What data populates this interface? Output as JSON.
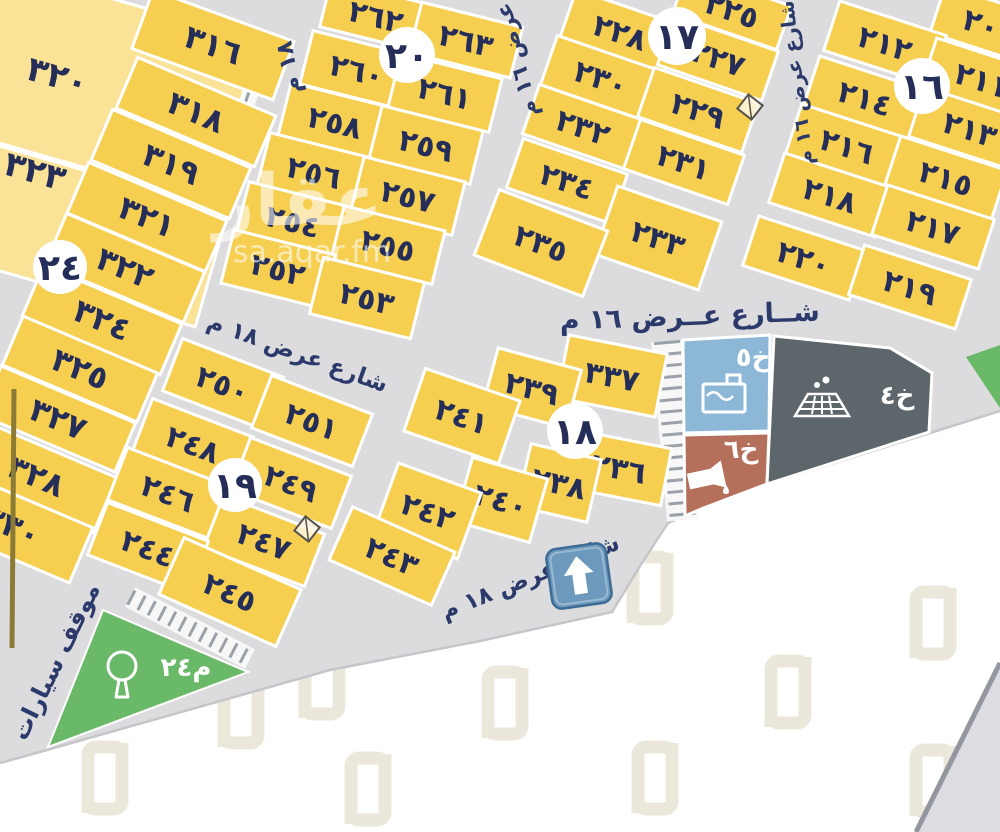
{
  "colors": {
    "parcel_yellow": "#f6cf50",
    "parcel_pale": "#fae296",
    "parcel_stroke": "#ffffff",
    "street_gray": "#dcdcde",
    "text_navy": "#242e58",
    "street_text": "#2b3a6b",
    "park_green": "#69b969",
    "service_blue": "#8db7d7",
    "service_red": "#b4705a",
    "service_dark": "#5d666b",
    "sign_blue": "#6d9abc",
    "sign_border": "#3d6b94",
    "watermark_beige": "#ece7db",
    "tick_gray": "#9ba1a8",
    "olive": "#8c7b35",
    "boundary_gray": "#c6c6ca",
    "wedge_gray": "#dcdce1",
    "wedge_edge": "#9496a0"
  },
  "map": {
    "blocks": [
      {
        "id": "24",
        "label": "٢٤",
        "x": 60,
        "y": 267,
        "r": 27
      },
      {
        "id": "20",
        "label": "٢٠",
        "x": 407,
        "y": 55,
        "r": 28
      },
      {
        "id": "17",
        "label": "١٧",
        "x": 677,
        "y": 36,
        "r": 29
      },
      {
        "id": "16",
        "label": "١٦",
        "x": 922,
        "y": 86,
        "r": 28
      },
      {
        "id": "19",
        "label": "١٩",
        "x": 235,
        "y": 485,
        "r": 27
      },
      {
        "id": "18",
        "label": "١٨",
        "x": 575,
        "y": 431,
        "r": 28
      }
    ],
    "parcels": [
      {
        "id": "320",
        "label": "٣٢٠",
        "x": 105,
        "y": 85,
        "w": 270,
        "h": 170,
        "a": 16,
        "v": "pale",
        "lx": 57,
        "ly": 90,
        "fs": 34
      },
      {
        "id": "323",
        "label": "٣٢٣",
        "x": 82,
        "y": 232,
        "w": 270,
        "h": 120,
        "a": 16,
        "v": "pale",
        "lx": 20,
        "ly": 187,
        "fs": 34
      },
      {
        "id": "316",
        "label": "٣١٦",
        "x": 213,
        "y": 45,
        "w": 150,
        "h": 62,
        "a": 20,
        "fs": 32
      },
      {
        "id": "318",
        "label": "٣١٨",
        "x": 196,
        "y": 112,
        "w": 150,
        "h": 55,
        "a": 23,
        "fs": 32
      },
      {
        "id": "319",
        "label": "٣١٩",
        "x": 171,
        "y": 164,
        "w": 150,
        "h": 55,
        "a": 23,
        "fs": 32
      },
      {
        "id": "321",
        "label": "٣٢١",
        "x": 147,
        "y": 217,
        "w": 150,
        "h": 55,
        "a": 23,
        "fs": 32
      },
      {
        "id": "322",
        "label": "٣٢٢",
        "x": 125,
        "y": 268,
        "w": 150,
        "h": 55,
        "a": 23,
        "fs": 32
      },
      {
        "id": "324",
        "label": "٣٢٤",
        "x": 102,
        "y": 320,
        "w": 150,
        "h": 55,
        "a": 23,
        "fs": 32
      },
      {
        "id": "325",
        "label": "٣٢٥",
        "x": 80,
        "y": 369,
        "w": 146,
        "h": 53,
        "a": 23,
        "fs": 32
      },
      {
        "id": "327",
        "label": "٣٢٧",
        "x": 58,
        "y": 419,
        "w": 146,
        "h": 53,
        "a": 23,
        "fs": 32
      },
      {
        "id": "328",
        "label": "٣٢٨",
        "x": 36,
        "y": 476,
        "w": 150,
        "h": 60,
        "a": 23,
        "fs": 32
      },
      {
        "id": "330",
        "label": "٣٣٠",
        "x": 12,
        "y": 526,
        "w": 150,
        "h": 60,
        "a": 23,
        "fs": 32
      },
      {
        "id": "262",
        "label": "٢٦٢",
        "x": 376,
        "y": 16,
        "w": 104,
        "h": 48,
        "a": 14
      },
      {
        "id": "263",
        "label": "٢٦٣",
        "x": 466,
        "y": 40,
        "w": 104,
        "h": 52,
        "a": 14
      },
      {
        "id": "260",
        "label": "٢٦٠",
        "x": 357,
        "y": 70,
        "w": 104,
        "h": 55,
        "a": 14
      },
      {
        "id": "261",
        "label": "٢٦١",
        "x": 445,
        "y": 93,
        "w": 104,
        "h": 55,
        "a": 14
      },
      {
        "id": "258",
        "label": "٢٥٨",
        "x": 335,
        "y": 122,
        "w": 104,
        "h": 55,
        "a": 14
      },
      {
        "id": "259",
        "label": "٢٥٩",
        "x": 426,
        "y": 145,
        "w": 104,
        "h": 55,
        "a": 14
      },
      {
        "id": "256",
        "label": "٢٥٦",
        "x": 314,
        "y": 172,
        "w": 104,
        "h": 55,
        "a": 14
      },
      {
        "id": "257",
        "label": "٢٥٧",
        "x": 408,
        "y": 196,
        "w": 104,
        "h": 55,
        "a": 14
      },
      {
        "id": "254",
        "label": "٢٥٤",
        "x": 293,
        "y": 221,
        "w": 104,
        "h": 55,
        "a": 14
      },
      {
        "id": "255",
        "label": "٢٥٥",
        "x": 388,
        "y": 245,
        "w": 104,
        "h": 55,
        "a": 14
      },
      {
        "id": "252",
        "label": "٢٥٢",
        "x": 278,
        "y": 269,
        "w": 104,
        "h": 55,
        "a": 14
      },
      {
        "id": "253",
        "label": "٢٥٣",
        "x": 367,
        "y": 298,
        "w": 104,
        "h": 58,
        "a": 14
      },
      {
        "id": "225",
        "label": "٢٢٥",
        "x": 732,
        "y": 10,
        "w": 110,
        "h": 46,
        "a": 19
      },
      {
        "id": "228",
        "label": "٢٢٨",
        "x": 620,
        "y": 32,
        "w": 110,
        "h": 52,
        "a": 19
      },
      {
        "id": "227",
        "label": "٢٢٧",
        "x": 718,
        "y": 58,
        "w": 110,
        "h": 52,
        "a": 19
      },
      {
        "id": "230",
        "label": "٢٣٠",
        "x": 601,
        "y": 78,
        "w": 110,
        "h": 52,
        "a": 19
      },
      {
        "id": "229",
        "label": "٢٢٩",
        "x": 698,
        "y": 110,
        "w": 110,
        "h": 52,
        "a": 19
      },
      {
        "id": "232",
        "label": "٢٣٢",
        "x": 583,
        "y": 127,
        "w": 110,
        "h": 52,
        "a": 19
      },
      {
        "id": "231",
        "label": "٢٣١",
        "x": 684,
        "y": 162,
        "w": 110,
        "h": 52,
        "a": 19
      },
      {
        "id": "234",
        "label": "٢٣٤",
        "x": 567,
        "y": 181,
        "w": 110,
        "h": 52,
        "a": 19
      },
      {
        "id": "233",
        "label": "٢٣٣",
        "x": 658,
        "y": 238,
        "w": 110,
        "h": 72,
        "a": 19
      },
      {
        "id": "235",
        "label": "٢٣٥",
        "x": 541,
        "y": 243,
        "w": 116,
        "h": 70,
        "a": 21
      },
      {
        "id": "209",
        "label": "٢٠٩",
        "x": 990,
        "y": 26,
        "w": 110,
        "h": 50,
        "a": 18
      },
      {
        "id": "212",
        "label": "٢١٢",
        "x": 885,
        "y": 43,
        "w": 112,
        "h": 52,
        "a": 18
      },
      {
        "id": "211",
        "label": "٢١١",
        "x": 982,
        "y": 80,
        "w": 112,
        "h": 52,
        "a": 18
      },
      {
        "id": "214",
        "label": "٢١٤",
        "x": 865,
        "y": 98,
        "w": 112,
        "h": 52,
        "a": 18
      },
      {
        "id": "213",
        "label": "٢١٣",
        "x": 970,
        "y": 129,
        "w": 112,
        "h": 52,
        "a": 18
      },
      {
        "id": "216",
        "label": "٢١٦",
        "x": 847,
        "y": 146,
        "w": 112,
        "h": 52,
        "a": 18
      },
      {
        "id": "215",
        "label": "٢١٥",
        "x": 946,
        "y": 178,
        "w": 112,
        "h": 52,
        "a": 18
      },
      {
        "id": "218",
        "label": "٢١٨",
        "x": 830,
        "y": 195,
        "w": 112,
        "h": 52,
        "a": 18
      },
      {
        "id": "217",
        "label": "٢١٧",
        "x": 933,
        "y": 227,
        "w": 112,
        "h": 52,
        "a": 18
      },
      {
        "id": "220",
        "label": "٢٢٠",
        "x": 804,
        "y": 258,
        "w": 112,
        "h": 52,
        "a": 18
      },
      {
        "id": "219",
        "label": "٢١٩",
        "x": 910,
        "y": 287,
        "w": 112,
        "h": 52,
        "a": 18
      },
      {
        "id": "250",
        "label": "٢٥٠",
        "x": 223,
        "y": 384,
        "w": 108,
        "h": 56,
        "a": 21
      },
      {
        "id": "251",
        "label": "٢٥١",
        "x": 312,
        "y": 421,
        "w": 108,
        "h": 56,
        "a": 21
      },
      {
        "id": "248",
        "label": "٢٤٨",
        "x": 193,
        "y": 444,
        "w": 108,
        "h": 56,
        "a": 21
      },
      {
        "id": "249",
        "label": "٢٤٩",
        "x": 291,
        "y": 483,
        "w": 108,
        "h": 56,
        "a": 21
      },
      {
        "id": "246",
        "label": "٢٤٦",
        "x": 168,
        "y": 493,
        "w": 108,
        "h": 56,
        "a": 21
      },
      {
        "id": "247",
        "label": "٢٤٧",
        "x": 264,
        "y": 541,
        "w": 108,
        "h": 56,
        "a": 21
      },
      {
        "id": "244",
        "label": "٢٤٤",
        "x": 148,
        "y": 548,
        "w": 108,
        "h": 56,
        "a": 21
      },
      {
        "id": "245",
        "label": "٢٤٥",
        "x": 230,
        "y": 592,
        "w": 128,
        "h": 62,
        "a": 24
      },
      {
        "id": "337",
        "label": "٣٣٧",
        "x": 612,
        "y": 376,
        "w": 100,
        "h": 64,
        "a": 11
      },
      {
        "id": "239",
        "label": "٢٣٩",
        "x": 532,
        "y": 388,
        "w": 86,
        "h": 60,
        "a": 15
      },
      {
        "id": "241",
        "label": "٢٤١",
        "x": 462,
        "y": 416,
        "w": 100,
        "h": 66,
        "a": 19
      },
      {
        "id": "236",
        "label": "٢٣٦",
        "x": 619,
        "y": 468,
        "w": 96,
        "h": 58,
        "a": 11
      },
      {
        "id": "238",
        "label": "٢٣٨",
        "x": 559,
        "y": 483,
        "w": 72,
        "h": 64,
        "a": 13
      },
      {
        "id": "240",
        "label": "٢٤٠",
        "x": 501,
        "y": 500,
        "w": 78,
        "h": 66,
        "a": 16
      },
      {
        "id": "242",
        "label": "٢٤٢",
        "x": 428,
        "y": 511,
        "w": 88,
        "h": 70,
        "a": 20
      },
      {
        "id": "243",
        "label": "٢٤٣",
        "x": 392,
        "y": 556,
        "w": 112,
        "h": 58,
        "a": 24
      }
    ],
    "services": [
      {
        "id": "kh5",
        "label": "خ٥",
        "color": "service_blue",
        "icon": "water-tank-icon",
        "points": "683,340 770,335 769,431 684,433",
        "label_x": 753,
        "label_y": 366,
        "icon_x": 724,
        "icon_y": 397
      },
      {
        "id": "kh6",
        "label": "خ٦",
        "color": "service_red",
        "icon": "fuel-icon",
        "points": "684,435 769,433 767,484 701,509 685,516",
        "label_x": 741,
        "label_y": 458,
        "icon_x": 710,
        "icon_y": 477
      },
      {
        "id": "kh4",
        "label": "خ٤",
        "color": "service_dark",
        "icon": "drain-icon",
        "points": "774,336 890,348 932,373 929,432 767,484",
        "label_x": 897,
        "label_y": 404,
        "icon_x": 822,
        "icon_y": 400
      }
    ],
    "park": {
      "points": "103,610 248,672 48,747",
      "label": "م٢٤",
      "label_x": 186,
      "label_y": 676,
      "tree_x": 122,
      "tree_y": 676
    },
    "green_sliver": "966,357 1000,345 1000,408",
    "street_labels": [
      {
        "text": "شــارع عــرض ١٦ م",
        "x": 690,
        "y": 325,
        "a": -2,
        "s": 27
      },
      {
        "text": "شارع عرض ١٨ م",
        "x": 295,
        "y": 360,
        "a": 20,
        "s": 23
      },
      {
        "text": "شارع عرض ١٨ م",
        "x": 533,
        "y": 584,
        "a": -22,
        "s": 23
      },
      {
        "text": "شارع عرض ١٦ م",
        "x": 803,
        "y": 82,
        "a": -97,
        "s": 20
      },
      {
        "text": "عرض ١٦ م",
        "x": 524,
        "y": 58,
        "a": -104,
        "s": 22
      },
      {
        "text": "١٨ م",
        "x": 296,
        "y": 66,
        "a": -101,
        "s": 23
      },
      {
        "text": "موقف سيارات",
        "x": 63,
        "y": 665,
        "a": -64,
        "s": 24
      }
    ],
    "markers": [
      {
        "x": 750,
        "y": 107
      },
      {
        "x": 307,
        "y": 529
      }
    ],
    "arrow_sign": {
      "x": 579,
      "y": 576,
      "size": 60,
      "a": -8
    },
    "plan_outline": "0,0 1000,0 1000,412 930,433 767,484 700,509 668,523 640,566 612,612 480,641 330,670 22,757 0,763",
    "boundary_line": "0,763 22,757 330,670 480,641 612,612 640,566 668,523 700,509 767,484 930,433 1000,411",
    "wedge": {
      "points": "1000,663 1000,832 916,832",
      "edge": "1000,663 916,832"
    },
    "olive_line": {
      "x1": 14,
      "y1": 389,
      "x2": 12,
      "y2": 648
    },
    "hatch_strips": [
      {
        "x1": 6,
        "y1": 16,
        "x2": 256,
        "y2": 102,
        "w": 16
      },
      {
        "x1": 130,
        "y1": 597,
        "x2": 250,
        "y2": 659,
        "w": 16
      },
      {
        "x1": 667,
        "y1": 341,
        "x2": 683,
        "y2": 520,
        "w": 26
      }
    ],
    "watermark_center": {
      "logo": "عقار",
      "domain": "sa.aqar.fm",
      "x": 298,
      "y": 225,
      "dx": 312,
      "dy": 262
    },
    "watermark_tiles": [
      [
        650,
        587
      ],
      [
        788,
        691
      ],
      [
        933,
        780
      ],
      [
        655,
        777
      ],
      [
        105,
        777
      ],
      [
        241,
        711
      ],
      [
        322,
        682
      ],
      [
        505,
        702
      ],
      [
        368,
        788
      ],
      [
        933,
        622
      ]
    ]
  }
}
